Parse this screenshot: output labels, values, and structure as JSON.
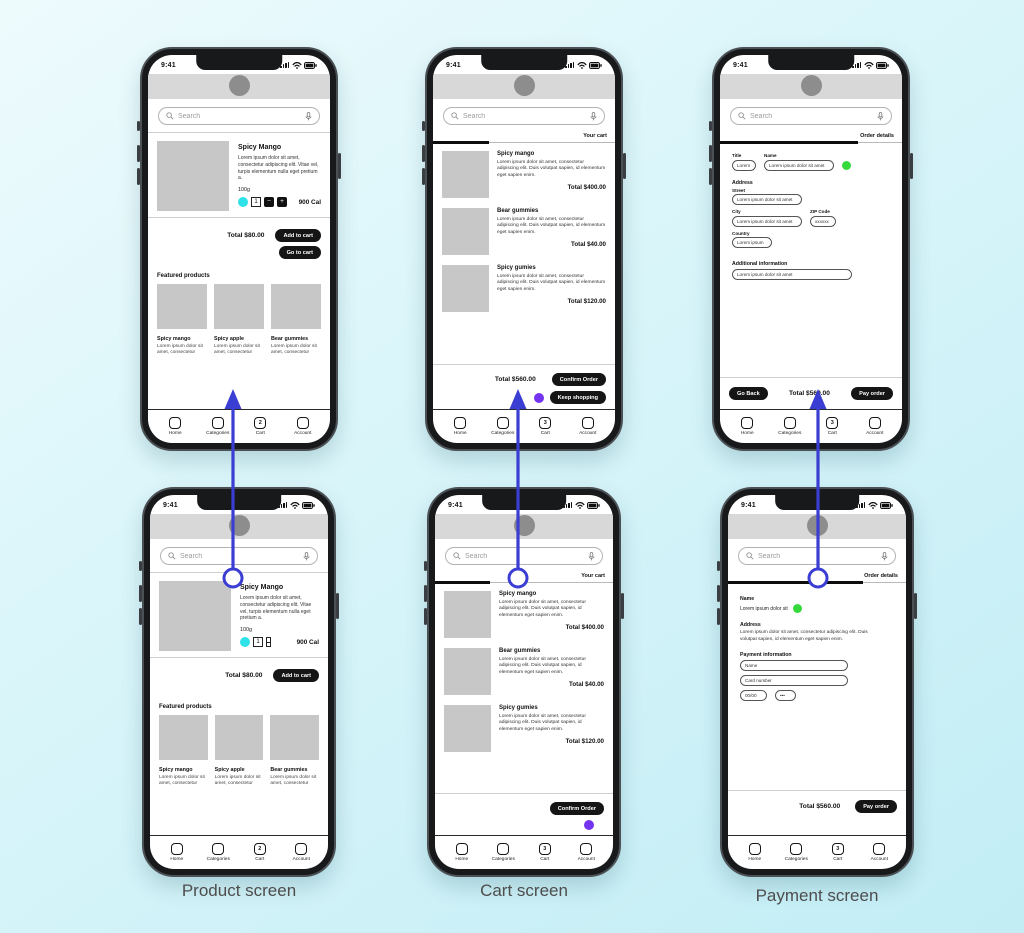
{
  "captions": {
    "product": "Product screen",
    "cart": "Cart screen",
    "payment": "Payment screen"
  },
  "status": {
    "time": "9:41"
  },
  "search": {
    "placeholder": "Search"
  },
  "nav": {
    "home": "Home",
    "categories": "Categories",
    "cart": "Cart",
    "account": "Account"
  },
  "badges": {
    "product": "2",
    "cart": "3",
    "payment": "3"
  },
  "colors": {
    "arrow": "#3b3ed2",
    "cyan_dot": "#2fe2e9",
    "purple_dot": "#7433f0",
    "green_dot": "#35d93c",
    "button_bg": "#151515"
  },
  "product": {
    "title": "Spicy Mango",
    "description": "Lorem ipsum dolor sit amet, consectetur adipiscing elit. Vitae vel, turpis elementum nulla eget pretium a.",
    "weight": "100g",
    "quantity": "1",
    "minus": "−",
    "plus": "+",
    "calories": "900 Cal",
    "total": "Total $80.00",
    "add_to_cart": "Add to cart",
    "go_to_cart": "Go to cart",
    "featured_heading": "Featured products",
    "featured": [
      {
        "name": "Spicy mango",
        "desc": "Lorem ipsum dolor sit amet, consectetur"
      },
      {
        "name": "Spicy apple",
        "desc": "Lorem ipsum dolor sit amet, consectetur"
      },
      {
        "name": "Bear gummies",
        "desc": "Lorem ipsum dolor sit amet, consectetur"
      }
    ]
  },
  "cart": {
    "header": "Your cart",
    "items": [
      {
        "name": "Spicy mango",
        "desc": "Lorem ipsum dolor sit amet, consectetur adipiscing elit. Duis volutpat sapien, id elementum eget sapien enim.",
        "total": "Total $400.00"
      },
      {
        "name": "Bear gummies",
        "desc": "Lorem ipsum dolor sit amet, consectetur adipiscing elit. Duis volutpat sapien, id elementum eget sapien enim.",
        "total": "Total $40.00"
      },
      {
        "name": "Spicy gumies",
        "desc": "Lorem ipsum dolor sit amet, consectetur adipiscing elit. Duis volutpat sapien, id elementum eget sapien enim.",
        "total": "Total $120.00"
      }
    ],
    "total": "Total $560.00",
    "confirm_order": "Confirm Order",
    "keep_shopping": "Keep shopping"
  },
  "order_form": {
    "header": "Order details",
    "title_label": "Title",
    "title_value": "Lorem",
    "name_label": "Name",
    "name_value": "Lorem ipsum dolor sit amet",
    "address_heading": "Address",
    "street_label": "Street",
    "street_value": "Lorem ipsum dolor sit amet",
    "city_label": "City",
    "city_value": "Lorem ipsum dolor sit amet",
    "zip_label": "ZIP Code",
    "zip_value": "xxxxxx",
    "country_label": "Country",
    "country_value": "Lorem ipsum",
    "additional_label": "Additional information",
    "additional_value": "Lorem ipsum dolor sit amet",
    "go_back": "Go Back",
    "total": "Total $560.00",
    "pay_order": "Pay order"
  },
  "payment_form": {
    "header": "Order details",
    "name_heading": "Name",
    "name_value": "Lorem ipsum dolor sit",
    "address_heading": "Address",
    "address_value": "Lorem ipsum dolor sit amet, consectetur adipiscing elit. Duis volutpat sapien, id elementum eget sapien enim.",
    "payment_heading": "Payment information",
    "name_placeholder": "Name",
    "card_placeholder": "Card number",
    "expiry_placeholder": "00/00",
    "cvv_placeholder": "•••",
    "total": "Total $560.00",
    "pay_order": "Pay order"
  }
}
